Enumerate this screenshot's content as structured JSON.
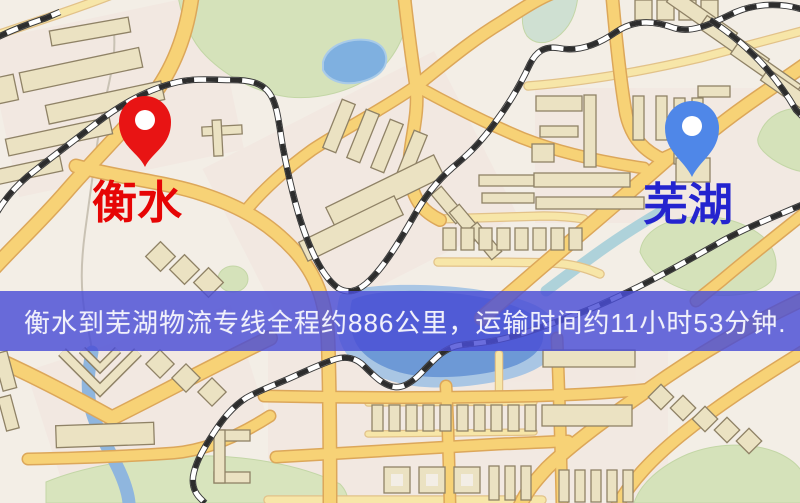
{
  "map": {
    "origin_label": "衡水",
    "destination_label": "芜湖",
    "origin_pin_color": "#e81414",
    "destination_pin_color": "#4f87e8",
    "origin_label_color": "#e60505",
    "destination_label_color": "#2424cf"
  },
  "banner": {
    "text": "衡水到芜湖物流专线全程约886公里，运输时间约11小时53分钟.",
    "background_color": "rgba(73,77,213,0.82)",
    "text_color": "#f0f0fb"
  },
  "route": {
    "origin": "衡水",
    "destination": "芜湖",
    "distance_km": "886",
    "duration_text": "11小时53分钟"
  },
  "palette": {
    "map_background": "#f3eee6",
    "road_fill": "#f7d276",
    "road_casing": "#dca75a",
    "minor_road_fill": "#f7e6a8",
    "park_green": "#d5e2ba",
    "water_blue": "#7fa9dc",
    "railway_dark": "#2d2d2d",
    "building_fill": "#ebe2c2"
  }
}
